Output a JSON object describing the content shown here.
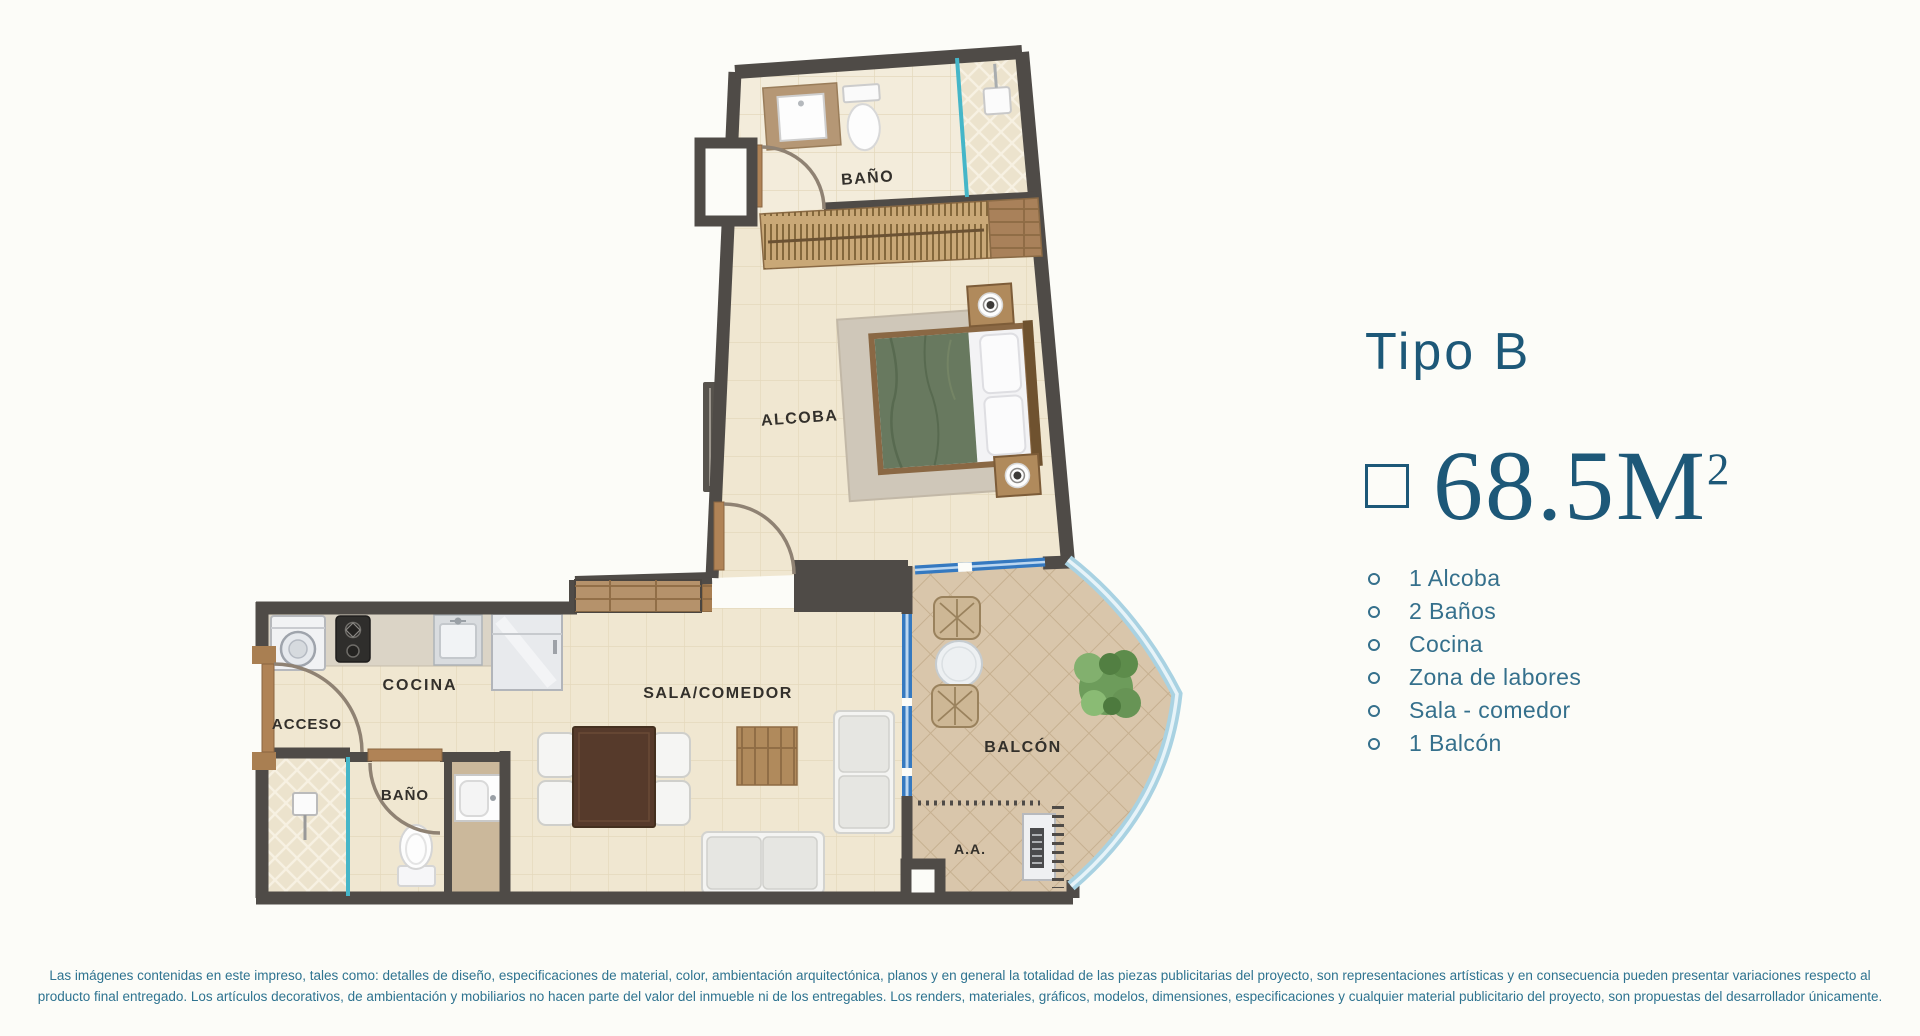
{
  "panel": {
    "title": "Tipo B",
    "area_value": "68.5M",
    "area_superscript": "2",
    "features": [
      "1 Alcoba",
      "2 Baños",
      "Cocina",
      "Zona de labores",
      "Sala - comedor",
      "1 Balcón"
    ]
  },
  "plan": {
    "rooms": {
      "bano_top": "BAÑO",
      "alcoba": "ALCOBA",
      "cocina": "COCINA",
      "acceso": "ACCESO",
      "bano_bottom": "BAÑO",
      "sala_comedor": "SALA/COMEDOR",
      "balcon": "BALCÓN",
      "aa": "A.A."
    }
  },
  "disclaimer": {
    "line1": "Las imágenes contenidas en este impreso, tales como: detalles de diseño, especificaciones de material, color, ambientación arquitectónica, planos y en general la totalidad de las piezas publicitarias del proyecto, son representaciones artísticas y en consecuencia pueden presentar variaciones respecto al",
    "line2": "producto final entregado. Los artículos decorativos, de ambientación y mobiliarios no hacen parte del valor del inmueble ni de los entregables. Los renders, materiales, gráficos, modelos, dimensiones, especificaciones y cualquier material publicitario del proyecto, son propuestas del desarrollador únicamente."
  },
  "colors": {
    "accent_dark": "#1d5878",
    "list_text": "#35708c",
    "disclaimer_text": "#2e7390",
    "wall": "#4f4b47",
    "floor_cream": "#f0e7d1",
    "floor_bath": "#f3ecdb",
    "wood": "#a97f52",
    "balcony_floor": "#d9c6ab",
    "window_blue": "#3579c0",
    "glass_teal": "#45b6c8",
    "glass_light": "#a9d2e2",
    "bed_green": "#68795f",
    "label_text": "#33302b"
  }
}
